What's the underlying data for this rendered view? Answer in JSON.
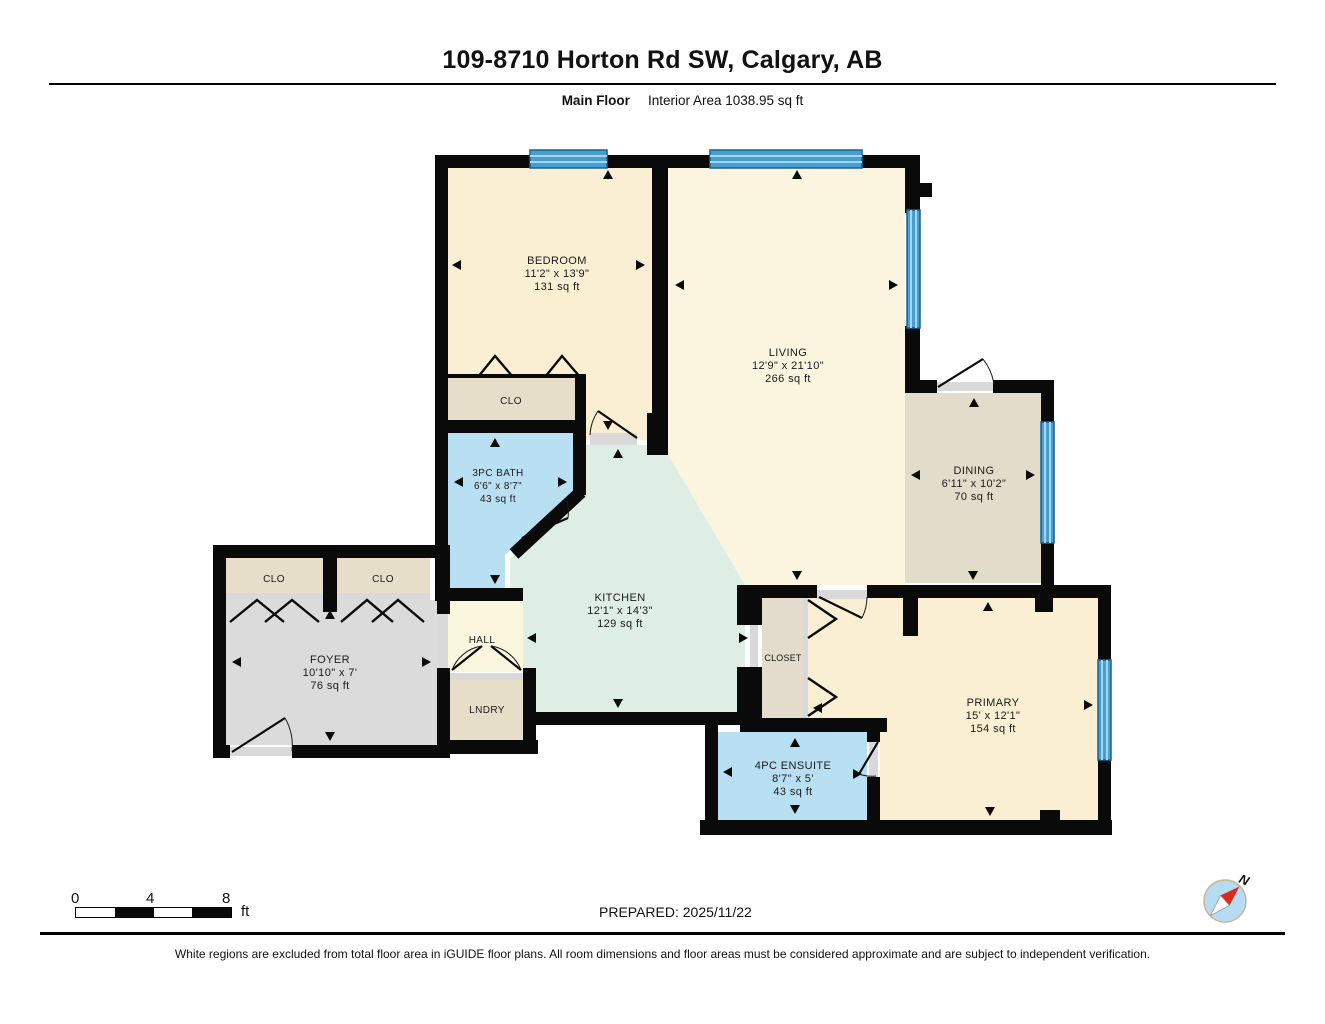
{
  "header": {
    "title": "109-8710 Horton Rd SW, Calgary, AB",
    "floor_label": "Main Floor",
    "interior_area_label": "Interior Area 1038.95 sq ft"
  },
  "rooms": {
    "bedroom": {
      "name": "BEDROOM",
      "dims": "11'2\" x 13'9\"",
      "area": "131 sq ft"
    },
    "living": {
      "name": "LIVING",
      "dims": "12'9\" x 21'10\"",
      "area": "266 sq ft"
    },
    "dining": {
      "name": "DINING",
      "dims": "6'11\" x 10'2\"",
      "area": "70 sq ft"
    },
    "bath": {
      "name": "3PC BATH",
      "dims": "6'6\" x 8'7\"",
      "area": "43 sq ft"
    },
    "kitchen": {
      "name": "KITCHEN",
      "dims": "12'1\" x 14'3\"",
      "area": "129 sq ft"
    },
    "foyer": {
      "name": "FOYER",
      "dims": "10'10\" x 7'",
      "area": "76 sq ft"
    },
    "primary": {
      "name": "PRIMARY",
      "dims": "15' x 12'1\"",
      "area": "154 sq ft"
    },
    "ensuite": {
      "name": "4PC ENSUITE",
      "dims": "8'7\" x 5'",
      "area": "43 sq ft"
    },
    "hall": {
      "name": "HALL"
    },
    "laundry": {
      "name": "LNDRY"
    },
    "closet": {
      "name": "CLOSET"
    },
    "clo": {
      "name": "CLO"
    }
  },
  "scale_bar": {
    "tick_labels": [
      "0",
      "4",
      "8"
    ],
    "unit": "ft"
  },
  "compass": {
    "north_label": "N"
  },
  "footer": {
    "prepared_label": "PREPARED: 2025/11/22",
    "disclaimer": "White regions are excluded from total floor area in iGUIDE floor plans. All room dimensions and floor areas must be considered approximate and are subject to independent verification."
  },
  "colors": {
    "wall": "#0a0a0a",
    "window_blue": "#459fd3",
    "bedroom_cream": "#faefd2",
    "living_cream": "#fbf5df",
    "dining_greige": "#e2dccb",
    "kitchen_mint": "#dfeee5",
    "bath_blue": "#b9dff3",
    "foyer_gray": "#dbdbdb",
    "closet_tan": "#e6dec8",
    "hall_cream": "#fbf6de",
    "compass_red": "#d92b1c"
  }
}
